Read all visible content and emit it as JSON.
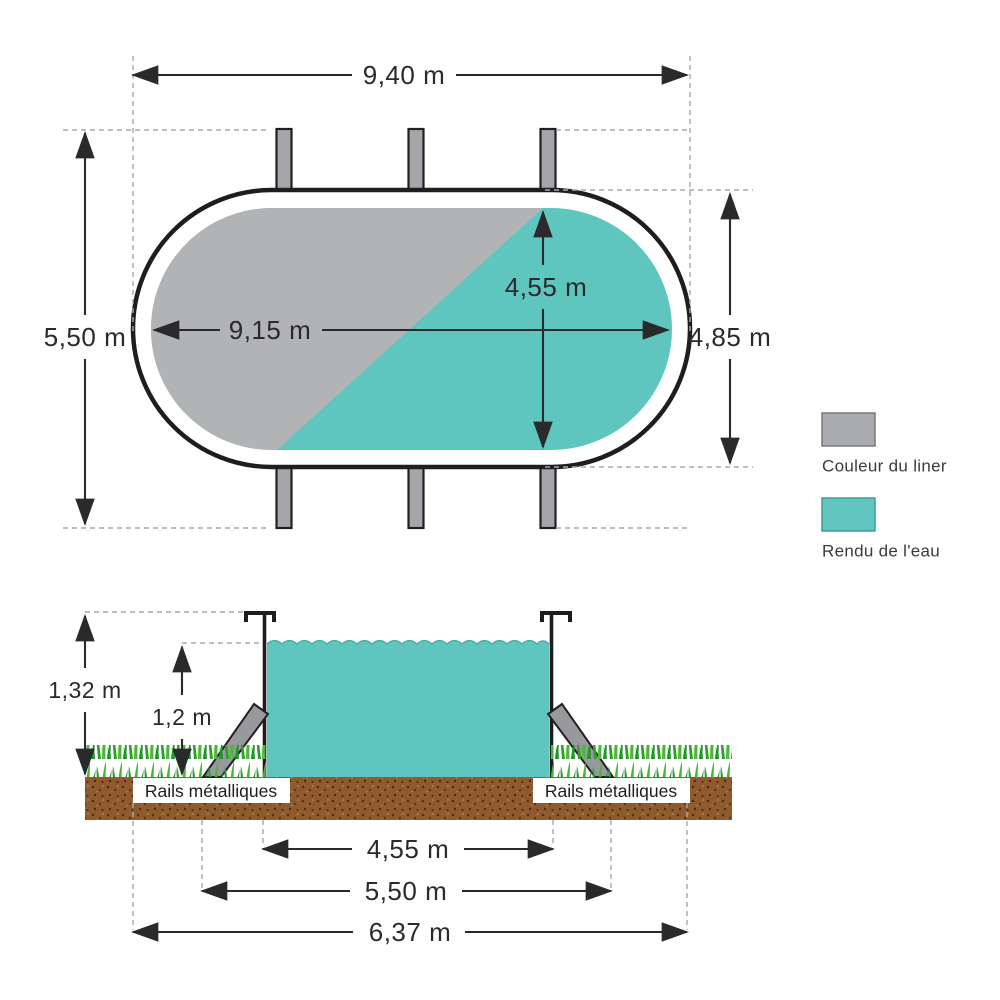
{
  "top_view": {
    "width_total": "9,40 m",
    "height_total": "5,50 m",
    "length_inner": "9,15 m",
    "width_inner": "4,55 m",
    "height_outer": "4,85 m"
  },
  "side_view": {
    "height_total": "1,32 m",
    "height_water": "1,2 m",
    "width_base": "4,55 m",
    "width_rails": "5,50 m",
    "width_ground": "6,37 m",
    "rails_left": "Rails métalliques",
    "rails_right": "Rails métalliques"
  },
  "legend": {
    "liner_label": "Couleur du liner",
    "liner_color": "#a9abae",
    "water_label": "Rendu de l'eau",
    "water_color": "#62c5c0"
  },
  "colors": {
    "liner_gray": "#b1b3b5",
    "water_teal": "#5ec5bf",
    "outline_black": "#231f20",
    "dirt_brown": "#8f5a2e",
    "grass_green": "#3aa838",
    "metal_gray": "#a4a6a9"
  }
}
